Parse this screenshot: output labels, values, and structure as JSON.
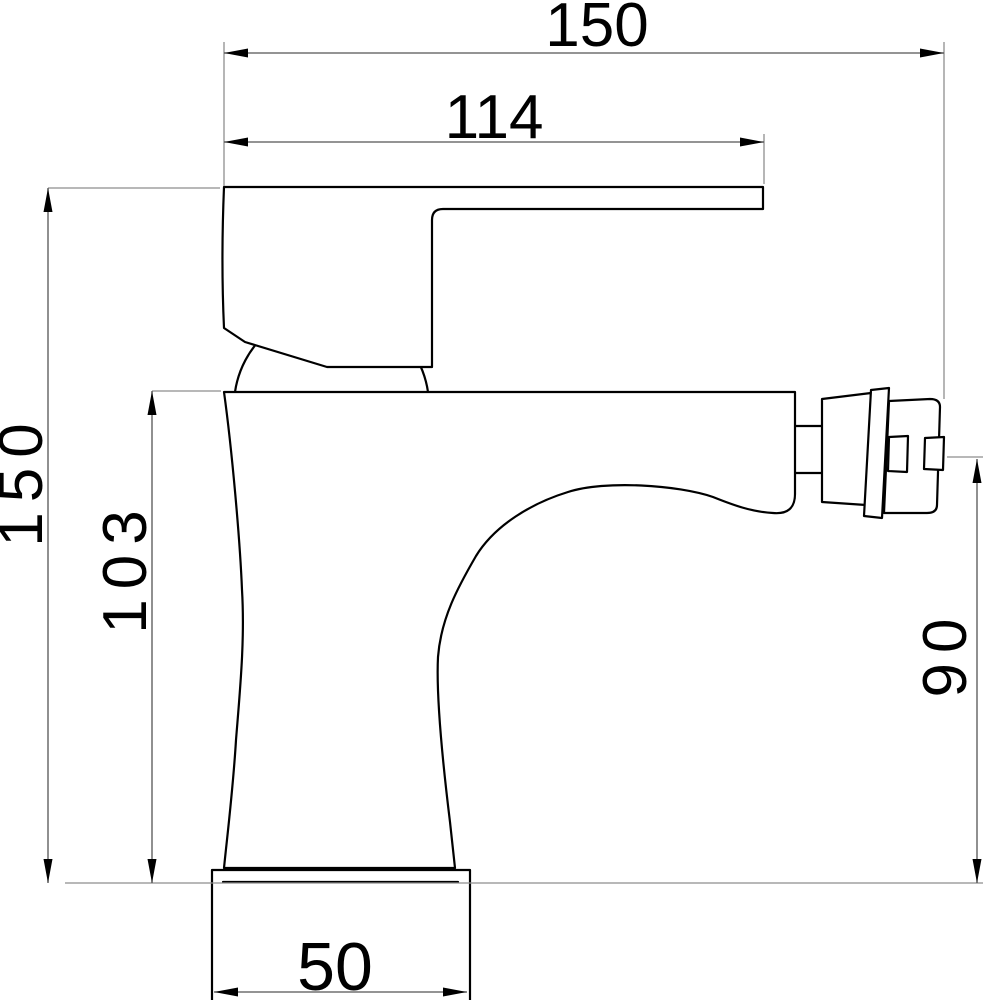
{
  "drawing": {
    "kind": "technical dimension drawing",
    "view": "faucet side elevation"
  },
  "dimensions": {
    "overall_width": "150",
    "handle_length": "114",
    "overall_height": "150",
    "body_height": "103",
    "outlet_height": "90",
    "base_width": "50"
  },
  "colors": {
    "outline": "#000000",
    "dimension_line": "#555555",
    "extension_line": "#8e8e8e",
    "arrow": "#000000",
    "background": "#ffffff",
    "label": "#000000"
  }
}
